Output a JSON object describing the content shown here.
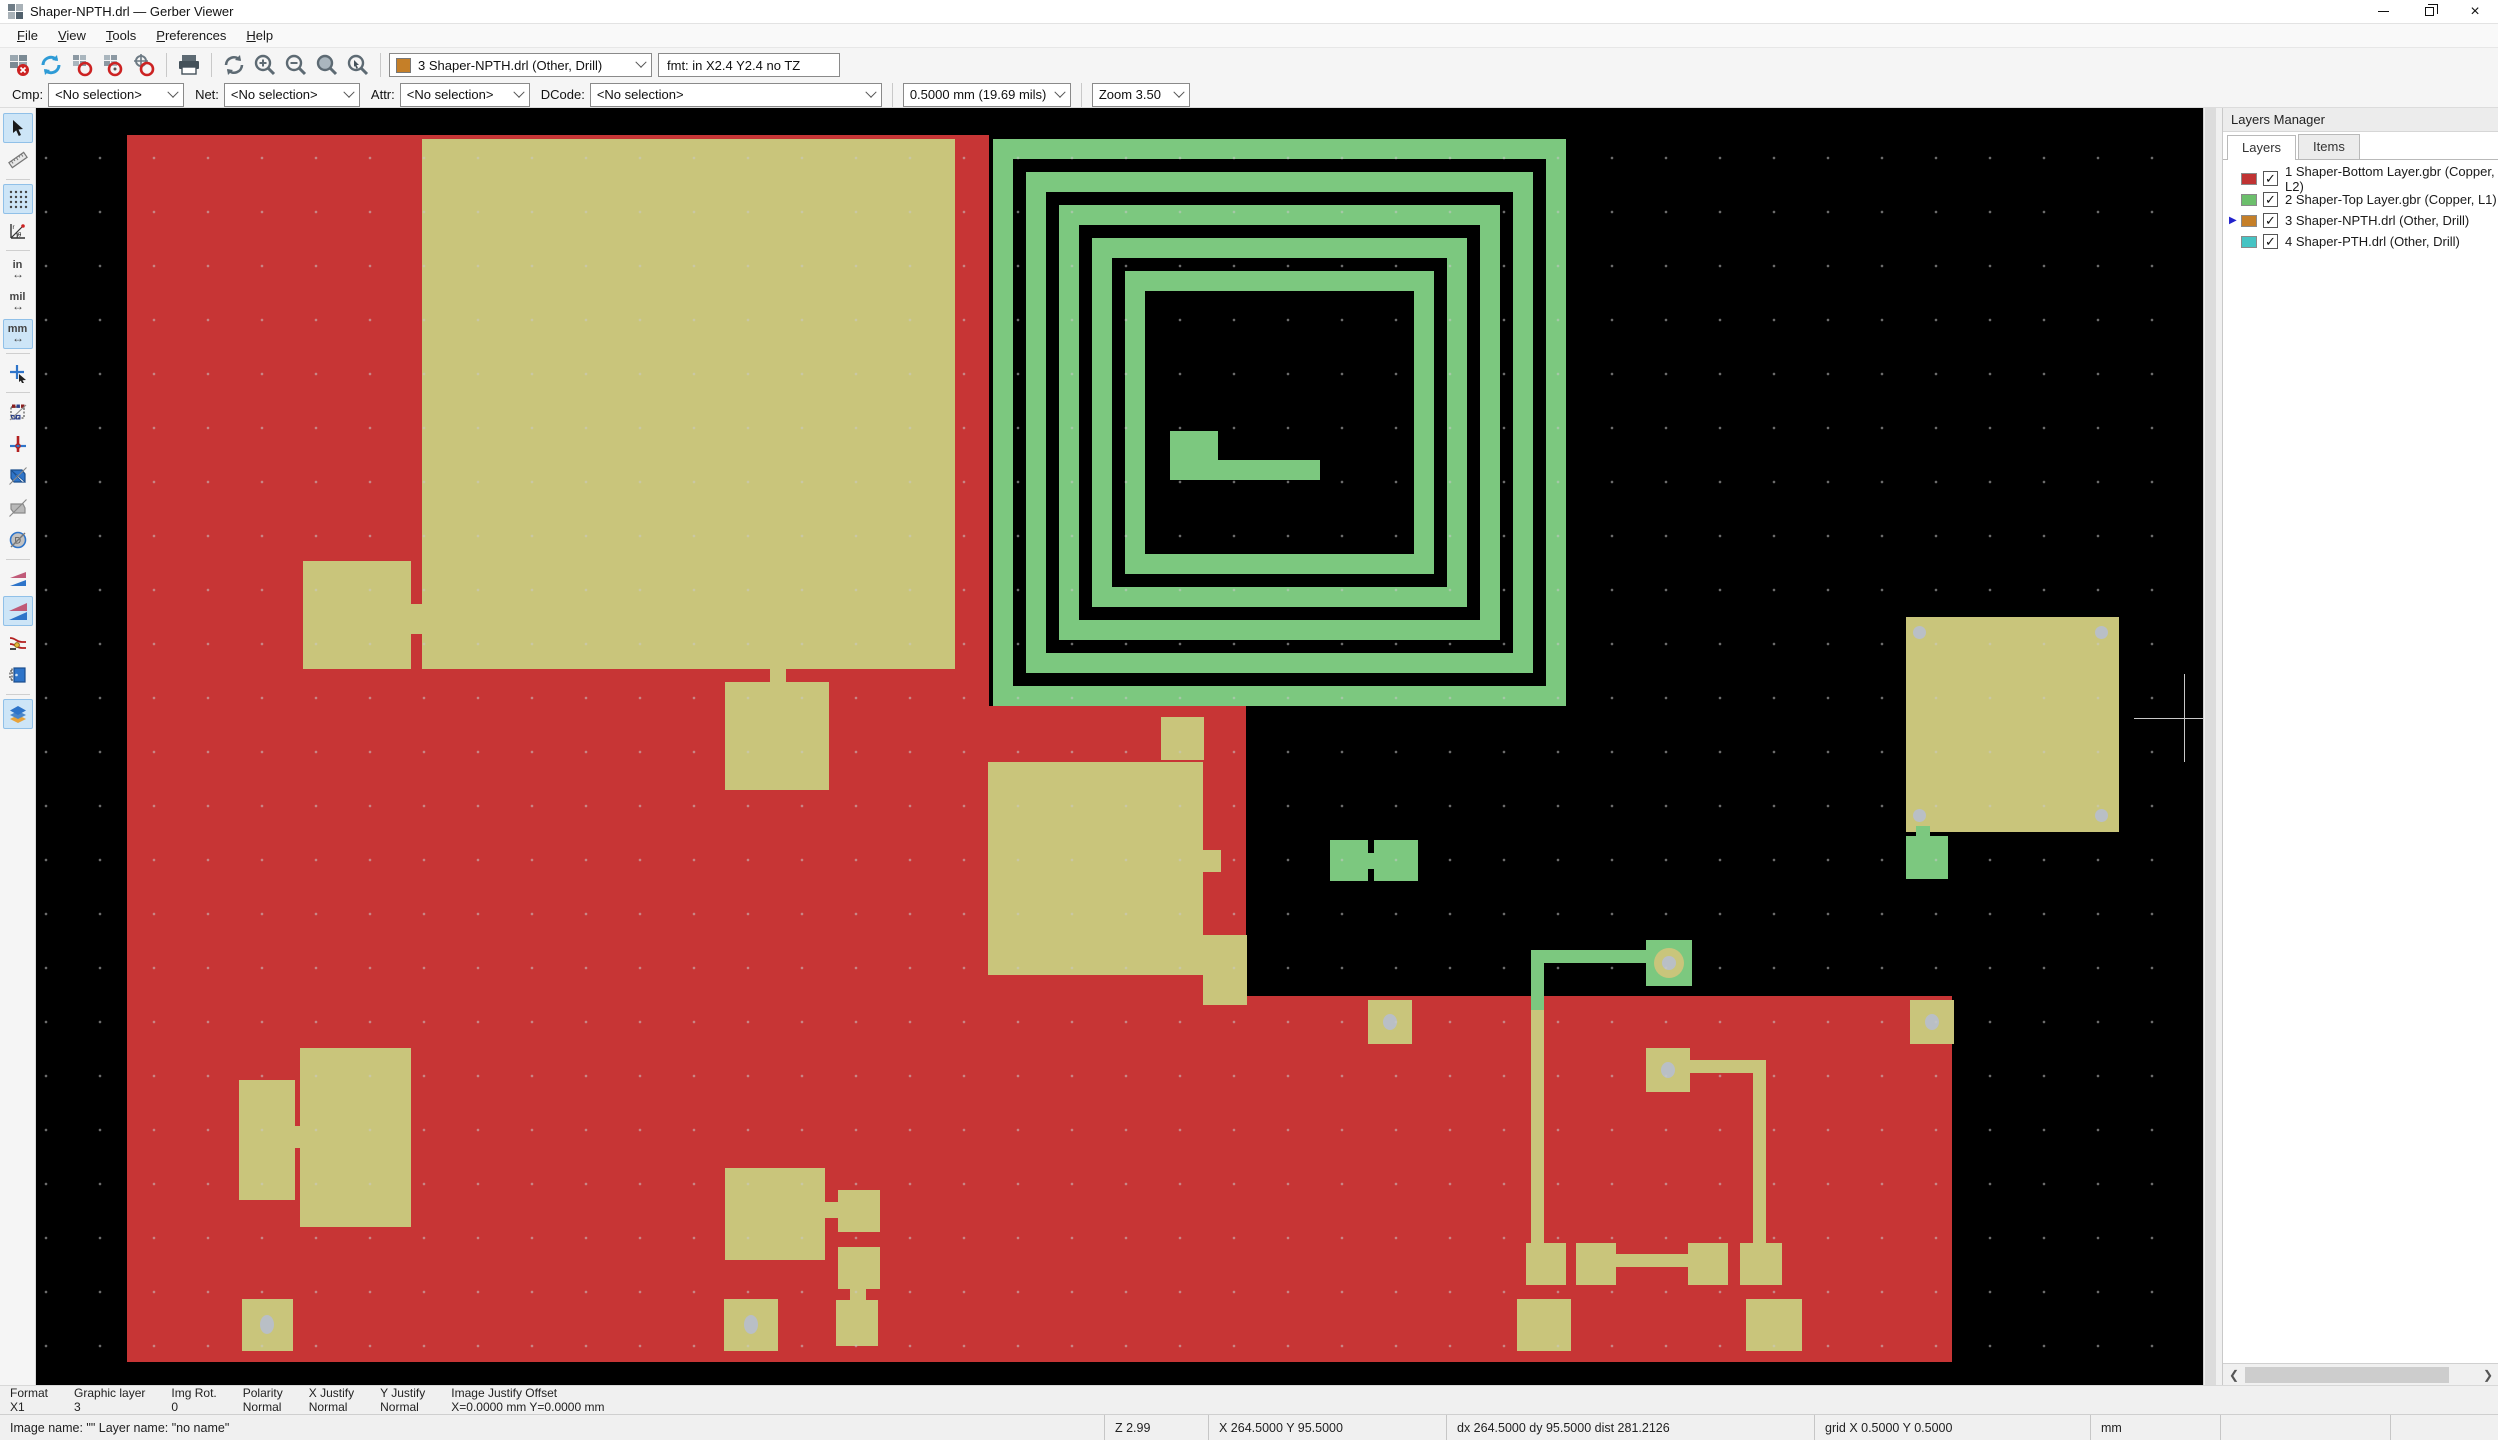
{
  "window": {
    "title": "Shaper-NPTH.drl — Gerber Viewer"
  },
  "menu": {
    "items": [
      {
        "label": "File"
      },
      {
        "label": "View"
      },
      {
        "label": "Tools"
      },
      {
        "label": "Preferences"
      },
      {
        "label": "Help"
      }
    ]
  },
  "toolbar": {
    "active_layer": "3 Shaper-NPTH.drl (Other, Drill)",
    "active_layer_color": "#c57f28",
    "format_info": "fmt: in X2.4 Y2.4 no TZ"
  },
  "filterbar": {
    "cmp_label": "Cmp:",
    "net_label": "Net:",
    "attr_label": "Attr:",
    "dcode_label": "DCode:",
    "cmp_value": "<No selection>",
    "net_value": "<No selection>",
    "attr_value": "<No selection>",
    "dcode_value": "<No selection>",
    "grid_value": "0.5000 mm (19.69 mils)",
    "zoom_value": "Zoom 3.50"
  },
  "left_toolbar": {
    "inch_label": "in",
    "mil_label": "mil",
    "mm_label": "mm"
  },
  "layers_panel": {
    "title": "Layers Manager",
    "tabs": [
      {
        "label": "Layers"
      },
      {
        "label": "Items"
      }
    ],
    "active_tab": "Layers",
    "checkmark": "✓",
    "selected_marker": "▶",
    "layers": [
      {
        "label": "1 Shaper-Bottom Layer.gbr (Copper, L2)",
        "color": "#c03333",
        "checked": true,
        "selected": false
      },
      {
        "label": "2 Shaper-Top Layer.gbr (Copper, L1)",
        "color": "#6cbf6c",
        "checked": true,
        "selected": false
      },
      {
        "label": "3 Shaper-NPTH.drl (Other, Drill)",
        "color": "#c57f28",
        "checked": true,
        "selected": true
      },
      {
        "label": "4 Shaper-PTH.drl (Other, Drill)",
        "color": "#45c3c3",
        "checked": true,
        "selected": false
      }
    ]
  },
  "info_band": {
    "columns": [
      {
        "label": "Format",
        "value": "X1"
      },
      {
        "label": "Graphic layer",
        "value": "3"
      },
      {
        "label": "Img Rot.",
        "value": "0"
      },
      {
        "label": "Polarity",
        "value": "Normal"
      },
      {
        "label": "X Justify",
        "value": "Normal"
      },
      {
        "label": "Y Justify",
        "value": "Normal"
      },
      {
        "label": "Image Justify Offset",
        "value": "X=0.0000 mm Y=0.0000 mm"
      }
    ]
  },
  "status_bar": {
    "names": "Image name: \"\"  Layer name: \"no name\"",
    "zoom": "Z 2.99",
    "cursor_xy": "X 264.5000  Y 95.5000",
    "delta": "dx 264.5000  dy 95.5000  dist 281.2126",
    "grid": "grid X 0.5000  Y 0.5000",
    "units": "mm"
  },
  "canvas": {
    "colors": {
      "bg": "#000000",
      "cb": "#c73535",
      "ct": "#7cc87f",
      "dr": "#c9c57b",
      "hole": "#b9bfc6",
      "cross": "#c8c8c8"
    },
    "shapes": [
      {
        "k": "rect",
        "c": "cb",
        "x": 91,
        "y": 27,
        "w": 1119,
        "h": 1227
      },
      {
        "k": "rect",
        "c": "bg",
        "x": 953,
        "y": 27,
        "w": 257,
        "h": 571
      },
      {
        "k": "rect",
        "c": "cb",
        "x": 1210,
        "y": 888,
        "w": 706,
        "h": 366
      },
      {
        "k": "rect",
        "c": "dr",
        "x": 386,
        "y": 31,
        "w": 533,
        "h": 530
      },
      {
        "k": "rect",
        "c": "dr",
        "x": 267,
        "y": 453,
        "w": 108,
        "h": 108
      },
      {
        "k": "rect",
        "c": "dr",
        "x": 369,
        "y": 496,
        "w": 22,
        "h": 30
      },
      {
        "k": "rect",
        "c": "dr",
        "x": 689,
        "y": 574,
        "w": 104,
        "h": 108
      },
      {
        "k": "rect",
        "c": "dr",
        "x": 734,
        "y": 558,
        "w": 16,
        "h": 18
      },
      {
        "k": "spiral",
        "x": 957,
        "y": 31,
        "w": 573,
        "h": 567,
        "turns": 5,
        "t": 20,
        "g": 13
      },
      {
        "k": "rect",
        "c": "ct",
        "x": 1134,
        "y": 323,
        "w": 48,
        "h": 48
      },
      {
        "k": "rect",
        "c": "ct",
        "x": 1134,
        "y": 352,
        "w": 150,
        "h": 20
      },
      {
        "k": "rect",
        "c": "dr",
        "x": 952,
        "y": 654,
        "w": 215,
        "h": 213
      },
      {
        "k": "rect",
        "c": "dr",
        "x": 1167,
        "y": 742,
        "w": 18,
        "h": 22
      },
      {
        "k": "rect",
        "c": "dr",
        "x": 1167,
        "y": 827,
        "w": 44,
        "h": 70
      },
      {
        "k": "rect",
        "c": "dr",
        "x": 1125,
        "y": 609,
        "w": 43,
        "h": 43
      },
      {
        "k": "rect",
        "c": "dr",
        "x": 203,
        "y": 972,
        "w": 56,
        "h": 120
      },
      {
        "k": "rect",
        "c": "dr",
        "x": 264,
        "y": 940,
        "w": 111,
        "h": 179
      },
      {
        "k": "rect",
        "c": "dr",
        "x": 257,
        "y": 1018,
        "w": 10,
        "h": 22
      },
      {
        "k": "rect",
        "c": "dr",
        "x": 206,
        "y": 1191,
        "w": 51,
        "h": 52
      },
      {
        "k": "ellipse",
        "x": 224,
        "y": 1207,
        "w": 14,
        "h": 19
      },
      {
        "k": "rect",
        "c": "dr",
        "x": 689,
        "y": 1060,
        "w": 100,
        "h": 92
      },
      {
        "k": "rect",
        "c": "dr",
        "x": 787,
        "y": 1094,
        "w": 17,
        "h": 16
      },
      {
        "k": "rect",
        "c": "dr",
        "x": 802,
        "y": 1082,
        "w": 42,
        "h": 42
      },
      {
        "k": "rect",
        "c": "dr",
        "x": 802,
        "y": 1139,
        "w": 42,
        "h": 42
      },
      {
        "k": "rect",
        "c": "dr",
        "x": 814,
        "y": 1179,
        "w": 16,
        "h": 15
      },
      {
        "k": "rect",
        "c": "dr",
        "x": 800,
        "y": 1192,
        "w": 42,
        "h": 46
      },
      {
        "k": "rect",
        "c": "dr",
        "x": 688,
        "y": 1191,
        "w": 54,
        "h": 52
      },
      {
        "k": "ellipse",
        "x": 708,
        "y": 1207,
        "w": 14,
        "h": 19
      },
      {
        "k": "rect",
        "c": "ct",
        "x": 1294,
        "y": 732,
        "w": 38,
        "h": 41
      },
      {
        "k": "rect",
        "c": "ct",
        "x": 1338,
        "y": 732,
        "w": 44,
        "h": 41
      },
      {
        "k": "rect",
        "c": "ct",
        "x": 1326,
        "y": 745,
        "w": 16,
        "h": 16
      },
      {
        "k": "rect",
        "c": "ct",
        "x": 1610,
        "y": 832,
        "w": 46,
        "h": 46
      },
      {
        "k": "circle",
        "c": "dr",
        "x": 1618,
        "y": 840,
        "w": 30,
        "h": 30
      },
      {
        "k": "ellipse",
        "x": 1626,
        "y": 848,
        "w": 14,
        "h": 14
      },
      {
        "k": "rect",
        "c": "ct",
        "x": 1501,
        "y": 842,
        "w": 110,
        "h": 13
      },
      {
        "k": "rect",
        "c": "ct",
        "x": 1495,
        "y": 842,
        "w": 13,
        "h": 62
      },
      {
        "k": "rect",
        "c": "dr",
        "x": 1495,
        "y": 902,
        "w": 13,
        "h": 240
      },
      {
        "k": "rect",
        "c": "dr",
        "x": 1490,
        "y": 1135,
        "w": 40,
        "h": 42
      },
      {
        "k": "rect",
        "c": "dr",
        "x": 1540,
        "y": 1135,
        "w": 40,
        "h": 42
      },
      {
        "k": "rect",
        "c": "dr",
        "x": 1652,
        "y": 1135,
        "w": 40,
        "h": 42
      },
      {
        "k": "rect",
        "c": "dr",
        "x": 1704,
        "y": 1135,
        "w": 42,
        "h": 42
      },
      {
        "k": "rect",
        "c": "dr",
        "x": 1576,
        "y": 1146,
        "w": 80,
        "h": 13
      },
      {
        "k": "rect",
        "c": "dr",
        "x": 1610,
        "y": 940,
        "w": 44,
        "h": 44
      },
      {
        "k": "ellipse",
        "x": 1625,
        "y": 954,
        "w": 14,
        "h": 16
      },
      {
        "k": "rect",
        "c": "dr",
        "x": 1654,
        "y": 952,
        "w": 76,
        "h": 13
      },
      {
        "k": "rect",
        "c": "dr",
        "x": 1717,
        "y": 952,
        "w": 13,
        "h": 185
      },
      {
        "k": "rect",
        "c": "dr",
        "x": 1481,
        "y": 1191,
        "w": 54,
        "h": 52
      },
      {
        "k": "rect",
        "c": "dr",
        "x": 1710,
        "y": 1191,
        "w": 56,
        "h": 52
      },
      {
        "k": "rect",
        "c": "dr",
        "x": 1874,
        "y": 892,
        "w": 44,
        "h": 44
      },
      {
        "k": "ellipse",
        "x": 1889,
        "y": 906,
        "w": 14,
        "h": 16
      },
      {
        "k": "rect",
        "c": "dr",
        "x": 1332,
        "y": 892,
        "w": 44,
        "h": 44
      },
      {
        "k": "ellipse",
        "x": 1347,
        "y": 906,
        "w": 14,
        "h": 16
      },
      {
        "k": "rect",
        "c": "dr",
        "x": 1870,
        "y": 509,
        "w": 213,
        "h": 215
      },
      {
        "k": "ellipse",
        "x": 1877,
        "y": 518,
        "w": 13,
        "h": 13
      },
      {
        "k": "ellipse",
        "x": 2059,
        "y": 518,
        "w": 13,
        "h": 13
      },
      {
        "k": "ellipse",
        "x": 1877,
        "y": 701,
        "w": 13,
        "h": 13
      },
      {
        "k": "ellipse",
        "x": 2059,
        "y": 701,
        "w": 13,
        "h": 13
      },
      {
        "k": "rect",
        "c": "ct",
        "x": 1880,
        "y": 718,
        "w": 14,
        "h": 12
      },
      {
        "k": "rect",
        "c": "ct",
        "x": 1870,
        "y": 728,
        "w": 42,
        "h": 43
      },
      {
        "k": "hline",
        "x": 2098,
        "y": 610,
        "w": 84,
        "h": 1
      },
      {
        "k": "vline",
        "x": 2148,
        "y": 566,
        "w": 1,
        "h": 88
      }
    ]
  }
}
